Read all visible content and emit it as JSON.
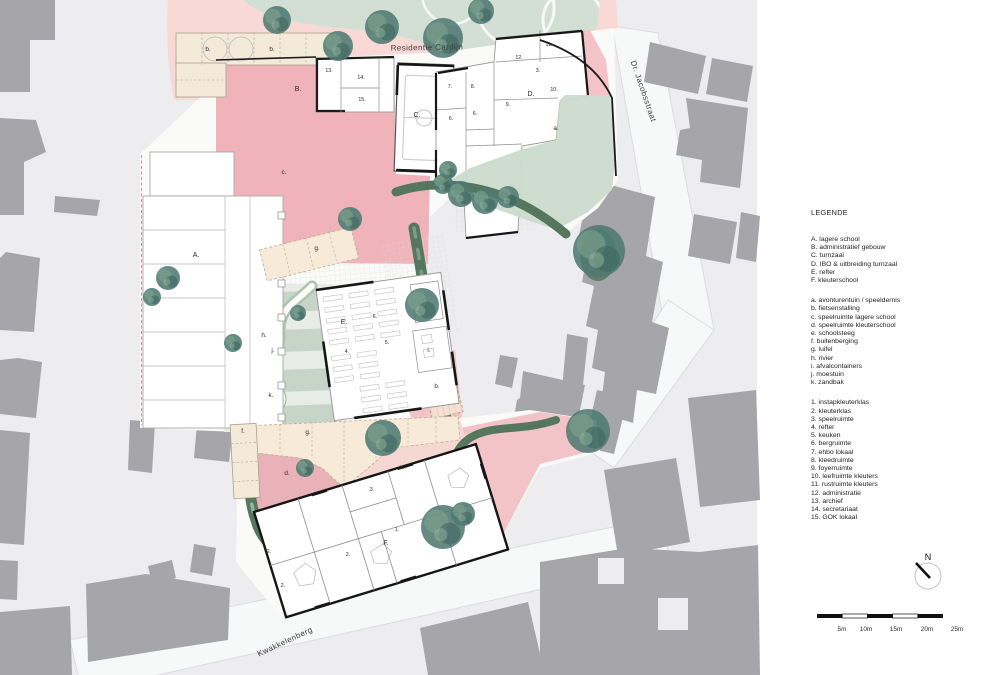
{
  "streets": {
    "residentie_cardijn": "Residentie Cardijn",
    "dr_jacobsstraat": "Dr. Jacobsstraat",
    "kwakkelenberg": "Kwakkelenberg"
  },
  "legend": {
    "heading": "LEGENDE",
    "buildings": [
      "A. lagere school",
      "B. administratief gebouw",
      "C. turnzaal",
      "D. IBO & uitbreiding turnzaal",
      "E. refter",
      "F. kleuterschool"
    ],
    "areas": [
      "a. avonturentuin / speeldernis",
      "b. fietsenstalling",
      "c. speelruimte lagere school",
      "d. speelruimte kleuterschool",
      "e. schoolsteeg",
      "f. buitenberging",
      "g. luifel",
      "h. rivier",
      "i. afvalcontainers",
      "j. moestuin",
      "k. zandbak"
    ],
    "rooms": [
      "1. instapkleuterklas",
      "2. kleuterklas",
      "3. speelruimte",
      "4. refter",
      "5. keuken",
      "6. bergruimte",
      "7. ehbo lokaal",
      "8. kleedruimte",
      "9. foyerruimte",
      "10. leefruimte kleuters",
      "11. rustruimte kleuters",
      "12. administratie",
      "13. archief",
      "14. secretariaat",
      "15. GOK lokaal"
    ]
  },
  "compass": {
    "label": "N"
  },
  "scalebar": {
    "labels": [
      "5m",
      "10m",
      "15m",
      "20m",
      "25m"
    ]
  },
  "colors": {
    "map_bg": "#ededef",
    "context_building": "#a6a6aa",
    "street": "#f7f8f8",
    "play_pink": "#efb3b9",
    "road_pink": "#f8d9d5",
    "canopy_cream": "#f4e8d7",
    "garden_sage": "#d3dfd4",
    "hedge_green": "#54775d",
    "tree_green": "#4f7a72"
  },
  "plan_labels": [
    {
      "kind": "street",
      "text": "Residentie Cardijn",
      "x": 427,
      "y": 50,
      "rot": -1,
      "size": 8
    },
    {
      "kind": "street",
      "text": "Dr. Jacobsstraat",
      "x": 641,
      "y": 92,
      "rot": 71,
      "size": 7.5
    },
    {
      "kind": "street",
      "text": "Kwakkelenberg",
      "x": 286,
      "y": 644,
      "rot": -25,
      "size": 8.5
    },
    {
      "kind": "letter",
      "text": "A.",
      "x": 196,
      "y": 257
    },
    {
      "kind": "letter",
      "text": "B.",
      "x": 298,
      "y": 91
    },
    {
      "kind": "letter",
      "text": "C.",
      "x": 417,
      "y": 117
    },
    {
      "kind": "letter",
      "text": "D.",
      "x": 531,
      "y": 96
    },
    {
      "kind": "letter",
      "text": "E.",
      "x": 344,
      "y": 324
    },
    {
      "kind": "letter",
      "text": "F.",
      "x": 386,
      "y": 545
    },
    {
      "kind": "area",
      "text": "a.",
      "x": 556,
      "y": 130
    },
    {
      "kind": "area",
      "text": "b.",
      "x": 208,
      "y": 51
    },
    {
      "kind": "area",
      "text": "b.",
      "x": 272,
      "y": 51
    },
    {
      "kind": "area",
      "text": "b.",
      "x": 437,
      "y": 388
    },
    {
      "kind": "area",
      "text": "c.",
      "x": 284,
      "y": 174
    },
    {
      "kind": "area",
      "text": "d.",
      "x": 287,
      "y": 475
    },
    {
      "kind": "area",
      "text": "e.",
      "x": 402,
      "y": 469
    },
    {
      "kind": "area",
      "text": "f.",
      "x": 243,
      "y": 433
    },
    {
      "kind": "area",
      "text": "g.",
      "x": 317,
      "y": 250
    },
    {
      "kind": "area",
      "text": "g.",
      "x": 308,
      "y": 434
    },
    {
      "kind": "area",
      "text": "h.",
      "x": 264,
      "y": 337
    },
    {
      "kind": "area",
      "text": "i.",
      "x": 429,
      "y": 352
    },
    {
      "kind": "area",
      "text": "j.",
      "x": 273,
      "y": 352
    },
    {
      "kind": "area",
      "text": "k.",
      "x": 271,
      "y": 397
    },
    {
      "kind": "room",
      "text": "13.",
      "x": 329,
      "y": 72
    },
    {
      "kind": "room",
      "text": "14.",
      "x": 361,
      "y": 79
    },
    {
      "kind": "room",
      "text": "15.",
      "x": 362,
      "y": 101
    },
    {
      "kind": "room",
      "text": "7.",
      "x": 450,
      "y": 88
    },
    {
      "kind": "room",
      "text": "8.",
      "x": 473,
      "y": 88
    },
    {
      "kind": "room",
      "text": "6.",
      "x": 451,
      "y": 120
    },
    {
      "kind": "room",
      "text": "6.",
      "x": 475,
      "y": 115
    },
    {
      "kind": "room",
      "text": "9.",
      "x": 508,
      "y": 106
    },
    {
      "kind": "room",
      "text": "10.",
      "x": 554,
      "y": 91
    },
    {
      "kind": "room",
      "text": "11.",
      "x": 549,
      "y": 46
    },
    {
      "kind": "room",
      "text": "12.",
      "x": 519,
      "y": 59
    },
    {
      "kind": "room",
      "text": "3.",
      "x": 538,
      "y": 72
    },
    {
      "kind": "room",
      "text": "4.",
      "x": 347,
      "y": 353
    },
    {
      "kind": "room",
      "text": "5.",
      "x": 387,
      "y": 344
    },
    {
      "kind": "room",
      "text": "6.",
      "x": 375,
      "y": 318
    },
    {
      "kind": "room",
      "text": "3.",
      "x": 372,
      "y": 491
    },
    {
      "kind": "room",
      "text": "1.",
      "x": 397,
      "y": 531
    },
    {
      "kind": "room",
      "text": "2.",
      "x": 269,
      "y": 553
    },
    {
      "kind": "room",
      "text": "2.",
      "x": 348,
      "y": 556
    },
    {
      "kind": "room",
      "text": "2.",
      "x": 283,
      "y": 587
    },
    {
      "kind": "compass",
      "text": "N",
      "x": 928,
      "y": 560
    },
    {
      "kind": "scale",
      "text": "5m",
      "x": 842,
      "y": 631
    },
    {
      "kind": "scale",
      "text": "10m",
      "x": 866,
      "y": 631
    },
    {
      "kind": "scale",
      "text": "15m",
      "x": 896,
      "y": 631
    },
    {
      "kind": "scale",
      "text": "20m",
      "x": 927,
      "y": 631
    },
    {
      "kind": "scale",
      "text": "25m",
      "x": 957,
      "y": 631
    }
  ]
}
